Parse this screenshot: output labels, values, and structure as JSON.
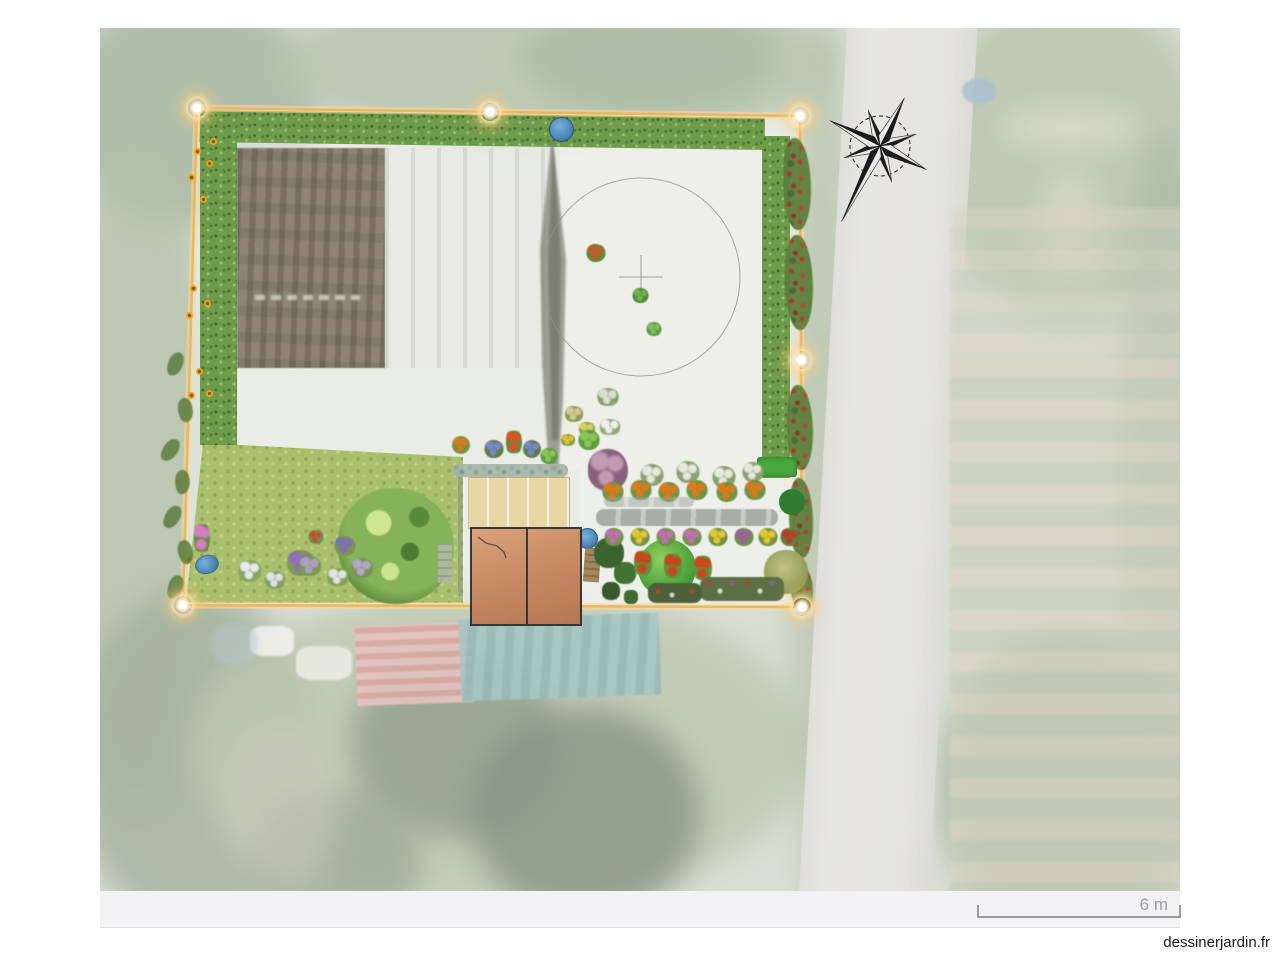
{
  "branding": {
    "watermark": "dessinerjardin.fr"
  },
  "scale_bar": {
    "label": "6 m"
  },
  "icons": {
    "compass": "compass-rose-icon",
    "corner_handle": "corner-marker-icon",
    "water_tank": "water-tank-icon"
  },
  "theme": {
    "boundary_color": "#e8b766",
    "marker_glow": "#ffd98f",
    "hedge_green": "#6f9b4b",
    "lawn_green": "#a9bf6d",
    "deck_wood": "#e9d6a5",
    "building_roof": "#c8895d",
    "water_blue": "#4c87b9",
    "soil_brown": "#8e8374",
    "road_gray": "#d7d6d1",
    "footer_bg": "#f2f2f5",
    "scale_text": "#9b9b9b",
    "watermark_text_color": "#1a1a1a",
    "photo_wash": "rgba(255,255,255,0.34)"
  }
}
